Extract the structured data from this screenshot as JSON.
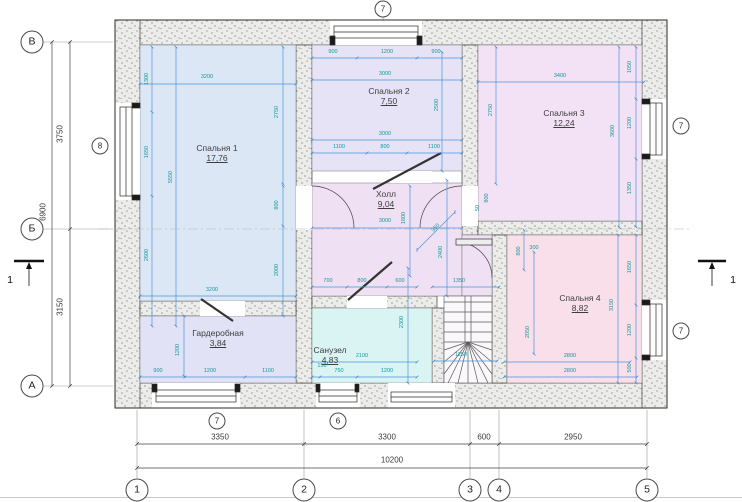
{
  "drawing": {
    "type": "floor-plan",
    "rooms": [
      {
        "id": "bedroom-1",
        "name": "Спальня 1",
        "area": "17,76",
        "x": 140,
        "y": 45,
        "w": 156,
        "h": 256,
        "color": "#dce7f6",
        "lx": 217,
        "ly": 143
      },
      {
        "id": "bedroom-2",
        "name": "Спальня 2",
        "area": "7,50",
        "x": 312,
        "y": 45,
        "w": 150,
        "h": 126,
        "color": "#e5e3f5",
        "lx": 389,
        "ly": 86
      },
      {
        "id": "bedroom-3",
        "name": "Спальня 3",
        "area": "12,24",
        "x": 478,
        "y": 45,
        "w": 164,
        "h": 176,
        "color": "#f3e1f5",
        "lx": 564,
        "ly": 108
      },
      {
        "id": "bedroom-4",
        "name": "Спальня 4",
        "area": "8,82",
        "x": 507,
        "y": 235,
        "w": 135,
        "h": 148,
        "color": "#f9dfe9",
        "lx": 580,
        "ly": 293
      },
      {
        "id": "hall",
        "name": "Холл",
        "area": "9,04",
        "x": 312,
        "y": 183,
        "w": 150,
        "h": 113,
        "color": "#f0e0f3",
        "lx": 386,
        "ly": 189
      },
      {
        "id": "corridor",
        "name": "",
        "area": "",
        "x": 462,
        "y": 235,
        "w": 30,
        "h": 61,
        "color": "#f0e0f3",
        "lx": 0,
        "ly": 0
      },
      {
        "id": "bathroom",
        "name": "Санузел",
        "area": "4,83",
        "x": 312,
        "y": 308,
        "w": 120,
        "h": 75,
        "color": "#d9f4f2",
        "lx": 330,
        "ly": 345
      },
      {
        "id": "wardrobe",
        "name": "Гардеробная",
        "area": "3,84",
        "x": 140,
        "y": 316,
        "w": 156,
        "h": 67,
        "color": "#e1e2f5",
        "lx": 218,
        "ly": 328
      }
    ],
    "axes_bottom": [
      {
        "t": "1",
        "x": 137
      },
      {
        "t": "2",
        "x": 304
      },
      {
        "t": "3",
        "x": 470
      },
      {
        "t": "4",
        "x": 499
      },
      {
        "t": "5",
        "x": 647
      }
    ],
    "axes_left": [
      {
        "t": "В",
        "y": 42
      },
      {
        "t": "Б",
        "y": 229
      },
      {
        "t": "А",
        "y": 386
      }
    ],
    "window_markers": [
      {
        "t": "7",
        "x": 383,
        "y": 9
      },
      {
        "t": "8",
        "x": 100,
        "y": 146
      },
      {
        "t": "7",
        "x": 681,
        "y": 126
      },
      {
        "t": "7",
        "x": 681,
        "y": 331
      },
      {
        "t": "7",
        "x": 217,
        "y": 421
      },
      {
        "t": "6",
        "x": 338,
        "y": 421
      }
    ],
    "section_marks": [
      {
        "t": "1",
        "x": 10,
        "y": 280
      },
      {
        "t": "1",
        "x": 733,
        "y": 280
      }
    ],
    "exterior_dims": [
      {
        "t": "3350",
        "x": 220,
        "y": 437
      },
      {
        "t": "3300",
        "x": 387,
        "y": 437
      },
      {
        "t": "600",
        "x": 484,
        "y": 437
      },
      {
        "t": "2950",
        "x": 573,
        "y": 437
      },
      {
        "t": "10200",
        "x": 392,
        "y": 460
      },
      {
        "t": "3750",
        "x": 60,
        "y": 134,
        "r": 1
      },
      {
        "t": "3150",
        "x": 60,
        "y": 307,
        "r": 1
      },
      {
        "t": "6900",
        "x": 43,
        "y": 212,
        "r": 1
      }
    ],
    "interior_dims": [
      {
        "t": "1300",
        "x": 147,
        "y": 79,
        "r": 1
      },
      {
        "t": "1650",
        "x": 147,
        "y": 152,
        "r": 1
      },
      {
        "t": "2600",
        "x": 147,
        "y": 255,
        "r": 1
      },
      {
        "t": "5550",
        "x": 171,
        "y": 177,
        "r": 1
      },
      {
        "t": "3200",
        "x": 207,
        "y": 77
      },
      {
        "t": "2750",
        "x": 277,
        "y": 112,
        "r": 1
      },
      {
        "t": "800",
        "x": 277,
        "y": 205,
        "r": 1
      },
      {
        "t": "2000",
        "x": 277,
        "y": 270,
        "r": 1
      },
      {
        "t": "3200",
        "x": 212,
        "y": 290
      },
      {
        "t": "900",
        "x": 333,
        "y": 52
      },
      {
        "t": "1200",
        "x": 387,
        "y": 52
      },
      {
        "t": "900",
        "x": 436,
        "y": 52
      },
      {
        "t": "3000",
        "x": 385,
        "y": 74
      },
      {
        "t": "3000",
        "x": 385,
        "y": 134
      },
      {
        "t": "1100",
        "x": 339,
        "y": 147
      },
      {
        "t": "800",
        "x": 385,
        "y": 147
      },
      {
        "t": "1100",
        "x": 434,
        "y": 147
      },
      {
        "t": "2500",
        "x": 437,
        "y": 105,
        "r": 1
      },
      {
        "t": "2750",
        "x": 491,
        "y": 110,
        "r": 1
      },
      {
        "t": "3000",
        "x": 385,
        "y": 221
      },
      {
        "t": "1800",
        "x": 404,
        "y": 218,
        "r": 1
      },
      {
        "t": "950",
        "x": 436,
        "y": 228,
        "r": 2
      },
      {
        "t": "2400",
        "x": 441,
        "y": 252,
        "r": 1
      },
      {
        "t": "50",
        "x": 478,
        "y": 208,
        "r": 1
      },
      {
        "t": "800",
        "x": 487,
        "y": 198,
        "r": 1
      },
      {
        "t": "3400",
        "x": 560,
        "y": 76
      },
      {
        "t": "1050",
        "x": 630,
        "y": 67,
        "r": 1
      },
      {
        "t": "1200",
        "x": 630,
        "y": 123,
        "r": 1
      },
      {
        "t": "1350",
        "x": 630,
        "y": 188,
        "r": 1
      },
      {
        "t": "3600",
        "x": 613,
        "y": 131,
        "r": 1
      },
      {
        "t": "300",
        "x": 534,
        "y": 248
      },
      {
        "t": "800",
        "x": 519,
        "y": 251,
        "r": 1
      },
      {
        "t": "2050",
        "x": 528,
        "y": 332,
        "r": 1
      },
      {
        "t": "1650",
        "x": 630,
        "y": 267,
        "r": 1
      },
      {
        "t": "1200",
        "x": 630,
        "y": 330,
        "r": 1
      },
      {
        "t": "500",
        "x": 630,
        "y": 368,
        "r": 1
      },
      {
        "t": "3150",
        "x": 612,
        "y": 305,
        "r": 1
      },
      {
        "t": "2800",
        "x": 570,
        "y": 356
      },
      {
        "t": "2800",
        "x": 570,
        "y": 371
      },
      {
        "t": "700",
        "x": 328,
        "y": 281
      },
      {
        "t": "800",
        "x": 362,
        "y": 281
      },
      {
        "t": "600",
        "x": 400,
        "y": 281
      },
      {
        "t": "2300",
        "x": 402,
        "y": 322,
        "r": 1
      },
      {
        "t": "2100",
        "x": 362,
        "y": 356
      },
      {
        "t": "150",
        "x": 322,
        "y": 366
      },
      {
        "t": "750",
        "x": 339,
        "y": 371
      },
      {
        "t": "1200",
        "x": 387,
        "y": 371
      },
      {
        "t": "1350",
        "x": 459,
        "y": 281
      },
      {
        "t": "1250",
        "x": 461,
        "y": 355
      },
      {
        "t": "1200",
        "x": 178,
        "y": 350,
        "r": 1
      },
      {
        "t": "900",
        "x": 158,
        "y": 371
      },
      {
        "t": "1200",
        "x": 210,
        "y": 371
      },
      {
        "t": "1100",
        "x": 268,
        "y": 371
      }
    ],
    "colors": {
      "dim_line": "#4f93d8",
      "dim_text": "#13989c",
      "wall_outline": "#2b2b2b",
      "axis_line": "#9a9a9a"
    }
  }
}
